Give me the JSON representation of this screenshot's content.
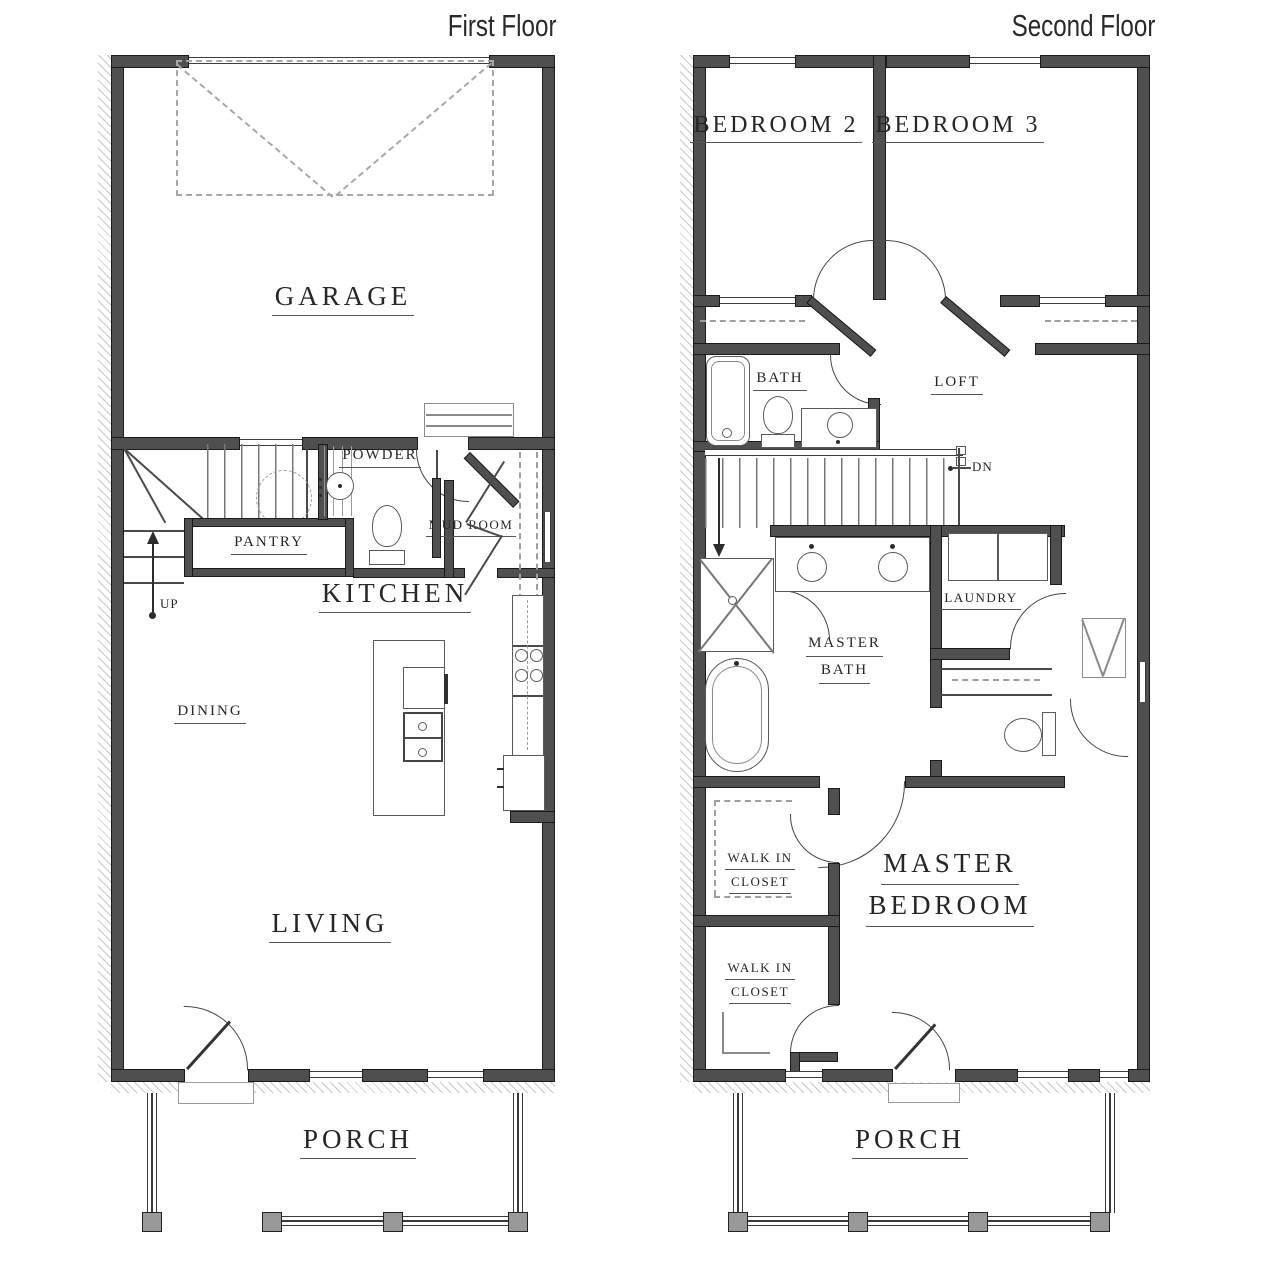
{
  "colors": {
    "wall": "#4f4f4f",
    "wall_edge": "#1a1a1a",
    "line": "#444444",
    "dashed": "#9e9e9e",
    "hatch": "#c8c8c8",
    "post": "#999999",
    "text": "#262626",
    "underline": "#555555",
    "background": "#ffffff"
  },
  "first_floor": {
    "title": "First Floor",
    "rooms": {
      "garage": "GARAGE",
      "powder": "POWDER",
      "mud_room": "MUD ROOM",
      "pantry": "PANTRY",
      "kitchen": "KITCHEN",
      "dining": "DINING",
      "living": "LIVING",
      "porch": "PORCH"
    },
    "stairs": {
      "up": "UP"
    }
  },
  "second_floor": {
    "title": "Second Floor",
    "rooms": {
      "bedroom2": "BEDROOM 2",
      "bedroom3": "BEDROOM 3",
      "bath": "BATH",
      "loft": "LOFT",
      "laundry": "LAUNDRY",
      "master_bath": [
        "MASTER",
        "BATH"
      ],
      "walk_in_closet_1": [
        "WALK IN",
        "CLOSET"
      ],
      "walk_in_closet_2": [
        "WALK IN",
        "CLOSET"
      ],
      "master_bedroom": [
        "MASTER",
        "BEDROOM"
      ],
      "porch": "PORCH"
    },
    "stairs": {
      "dn": "DN"
    }
  }
}
